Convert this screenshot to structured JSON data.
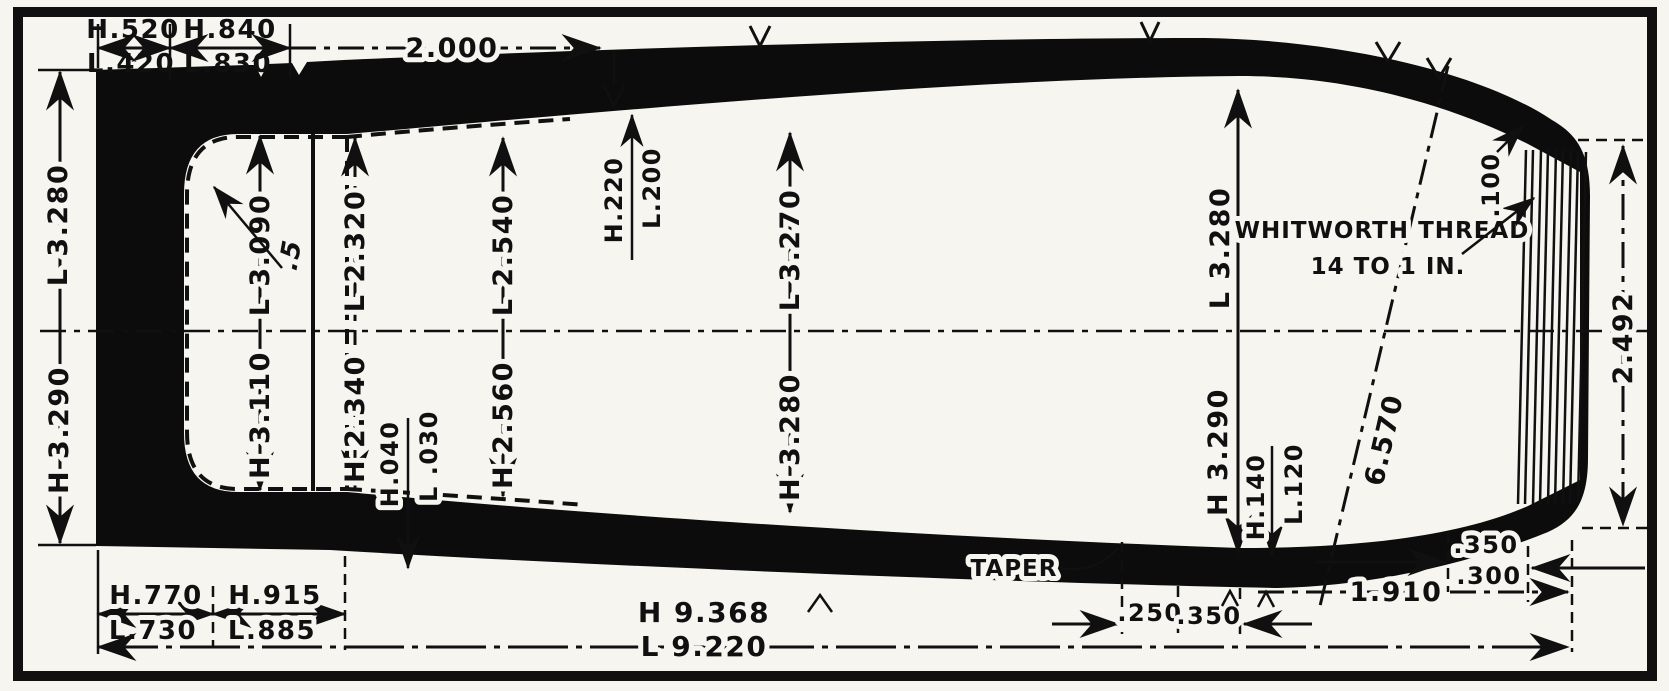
{
  "top": {
    "seg1_h": "H.520",
    "seg1_l": "L.420",
    "seg2_h": "H.840",
    "seg2_l": "L.830",
    "span": "2.000"
  },
  "left": {
    "upper": "L 3.280",
    "lower": "H 3.290"
  },
  "interior": {
    "base_upper": "L 3.090",
    "base_lower": "H 3.110",
    "radius": ".5",
    "st1_upper": "L 2.320",
    "st1_lower": "H 2.340",
    "step_h": "H.040",
    "step_l": "L .030",
    "st2_upper": "L 2.540",
    "st2_lower": "H 2.560",
    "wall_top_h": "H.220",
    "wall_top_l": "L.200",
    "mid_upper": "L 3.270",
    "mid_lower": "H 3.280",
    "right_upper": "L 3.280",
    "right_lower": "H 3.290",
    "wall_bottom_h": "H.140",
    "wall_bottom_l": "L.120"
  },
  "thread_note": {
    "line1": "WHITWORTH THREAD",
    "line2": "14 TO 1 IN."
  },
  "right": {
    "thread_step": ".100",
    "mouth_diameter": "2.492",
    "diagonal_length": "6.570",
    "mouth_top": ".350",
    "mouth_bottom": ".300",
    "mouth_span": "1.910"
  },
  "bottom": {
    "seg1_h": "H.770",
    "seg1_l": "L.730",
    "seg2_h": "H.915",
    "seg2_l": "L.885",
    "taper_label": "TAPER",
    "taper_a": ".250",
    "taper_b": ".350",
    "overall_h": "H 9.368",
    "overall_l": "L 9.220"
  }
}
